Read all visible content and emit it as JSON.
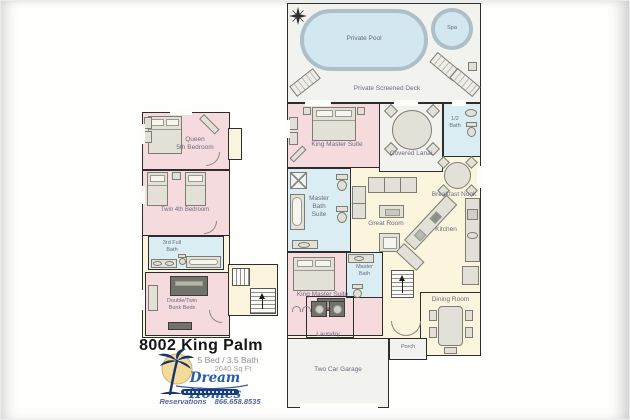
{
  "palette": {
    "bedroom_pink": "#f5dbde",
    "bath_blue": "#d9edf3",
    "living_cream": "#faf5dc",
    "deck_gray": "#f2f2ee",
    "pool_blue": "#d3e7f0",
    "wall": "#2d2d2d",
    "brand_blue": "#2b5cab"
  },
  "deck": {
    "pool_label": "Private Pool",
    "spa_label": "Spa",
    "deck_label": "Private Screened Deck"
  },
  "main_floor": {
    "king_master_1": "King Master Suite",
    "covered_lanai": "Covered Lanai",
    "half_bath": "1/2\nBath",
    "master_bath_suite": "Master\nBath\nSuite",
    "great_room": "Great Room",
    "breakfast_nook": "Breakfast Nook",
    "kitchen": "Kitchen",
    "king_master_2": "King Master Suite",
    "master_bath_2": "Master\nBath",
    "laundry": "Laundry",
    "dining_room": "Dining Room",
    "porch": "Porch",
    "garage": "Two Car Garage"
  },
  "second_floor": {
    "queen_bedroom": "Queen\n5th Bedroom",
    "twin_bedroom": "Twin 4th Bedroom",
    "full_bath": "3rd Full\nBath",
    "bunk_room": "Double/Twin\nBunk Beds"
  },
  "title_block": {
    "property_name": "8002 King Palm",
    "beds_baths": "5 Bed / 3.5 Bath",
    "square_feet": "2640 Sq Ft",
    "brand": "Dream Homes",
    "reservations": "Reservations 866.658.8535"
  }
}
